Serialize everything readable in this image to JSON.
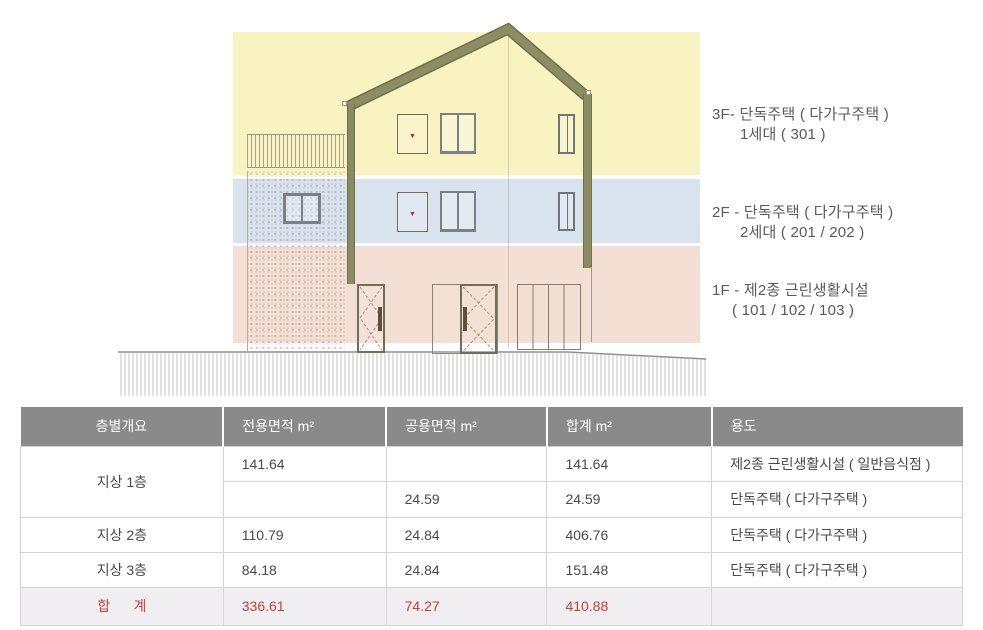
{
  "drawing": {
    "floors": [
      {
        "id": "3F",
        "band_color": "#f9f2c1",
        "label_line1": "3F- 단독주택 ( 다가구주택 )",
        "label_line2": "1세대 ( 301 )"
      },
      {
        "id": "2F",
        "band_color": "#d9e3ee",
        "label_line1": "2F - 단독주택 ( 다가구주택 )",
        "label_line2": "2세대 ( 201 / 202 )"
      },
      {
        "id": "1F",
        "band_color": "#f3dfd3",
        "label_line1": "1F - 제2종 근린생활시설",
        "label_line2": "( 101 / 102 / 103 )"
      }
    ],
    "door_marker": "▼",
    "roof_color": "#8d8d63"
  },
  "table": {
    "header_bg": "#8a8a8a",
    "accent_red": "#c2423c",
    "headers": [
      "층별개요",
      "전용면적 m²",
      "공용면적 m²",
      "합계 m²",
      "용도"
    ],
    "rows": [
      {
        "floor": "지상 1층",
        "exclusive": "141.64",
        "common": "",
        "total": "141.64",
        "use": "제2종 근린생활시설 ( 일반음식점 )"
      },
      {
        "floor": "",
        "exclusive": "",
        "common": "24.59",
        "total": "24.59",
        "use": "단독주택 ( 다가구주택 )"
      },
      {
        "floor": "지상 2층",
        "exclusive": "110.79",
        "common": "24.84",
        "total": "406.76",
        "use": "단독주택 ( 다가구주택 )"
      },
      {
        "floor": "지상 3층",
        "exclusive": "84.18",
        "common": "24.84",
        "total": "151.48",
        "use": "단독주택 ( 다가구주택 )"
      },
      {
        "floor": "합      계",
        "exclusive": "336.61",
        "common": "74.27",
        "total": "410.88",
        "use": ""
      }
    ]
  }
}
